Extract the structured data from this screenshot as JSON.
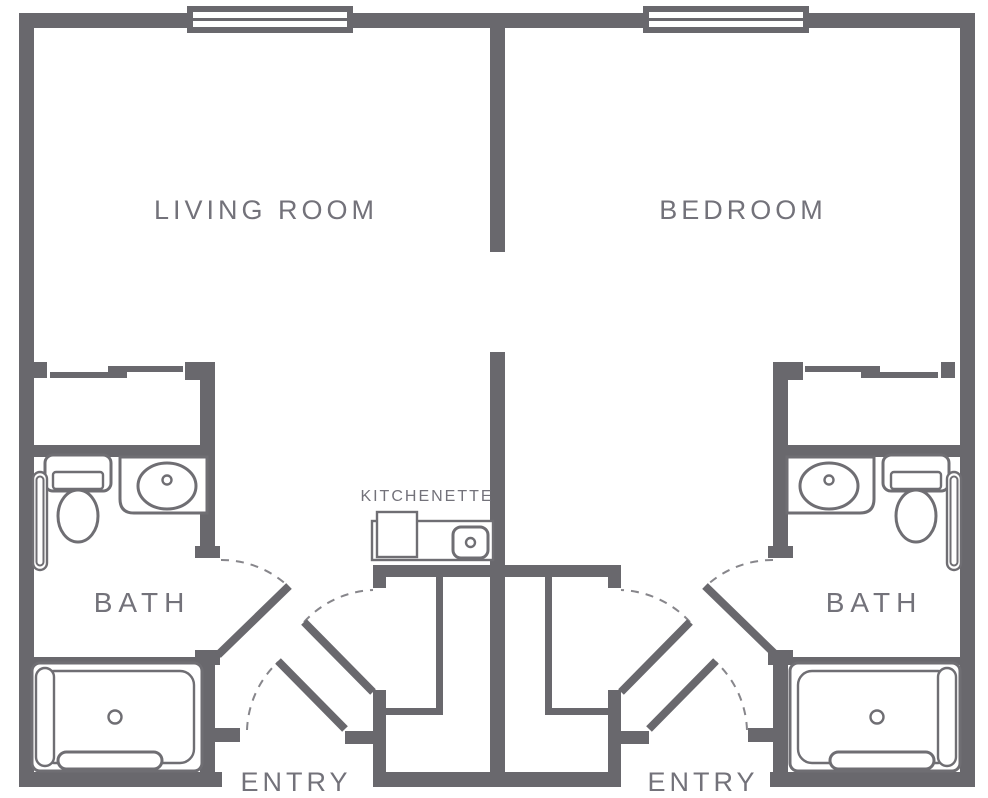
{
  "colors": {
    "wall": "#69686d",
    "fixture": "#6f6e73",
    "text": "#73727a",
    "arc": "#87868b",
    "background": "#ffffff"
  },
  "labels": {
    "living_room": "LIVING ROOM",
    "bedroom": "BEDROOM",
    "bath_left": "BATH",
    "bath_right": "BATH",
    "kitchenette": "KITCHENETTE",
    "entry_left": "ENTRY",
    "entry_right": "ENTRY"
  },
  "fixtures": {
    "left_bath": [
      "toilet",
      "vanity-sink",
      "grab-bar",
      "bathtub"
    ],
    "right_bath": [
      "toilet",
      "vanity-sink",
      "grab-bar",
      "bathtub"
    ],
    "kitchenette": [
      "appliance",
      "sink"
    ],
    "windows": 2,
    "sliding_closets": 2,
    "door_swings": 6
  }
}
